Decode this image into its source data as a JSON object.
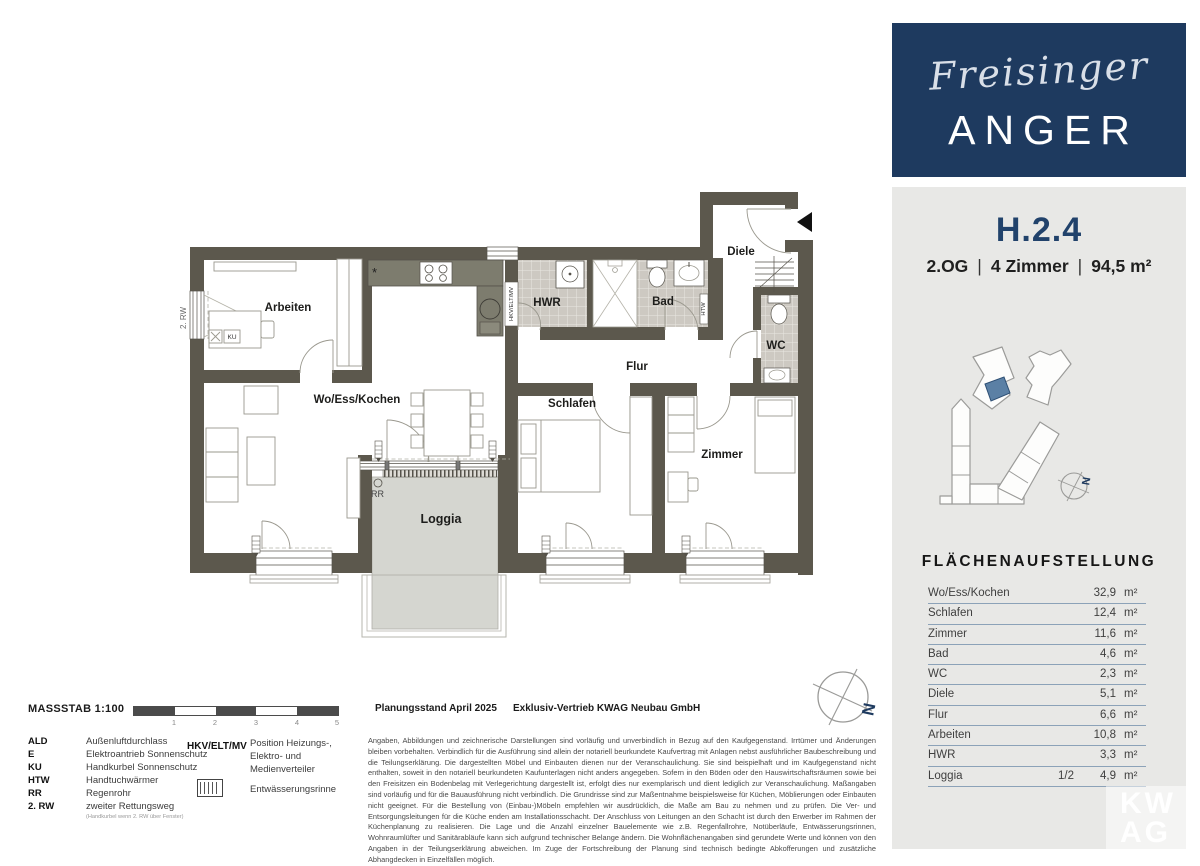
{
  "branding": {
    "script": "Freisinger",
    "name": "ANGER"
  },
  "unit": {
    "id": "H.2.4",
    "floor": "2.OG",
    "rooms": "4 Zimmer",
    "area": "94,5 m²",
    "separator": "|"
  },
  "area_table": {
    "title": "FLÄCHENAUFSTELLUNG",
    "rows": [
      {
        "label": "Wo/Ess/Kochen",
        "fraction": "",
        "value": "32,9",
        "unit": "m²"
      },
      {
        "label": "Schlafen",
        "fraction": "",
        "value": "12,4",
        "unit": "m²"
      },
      {
        "label": "Zimmer",
        "fraction": "",
        "value": "11,6",
        "unit": "m²"
      },
      {
        "label": "Bad",
        "fraction": "",
        "value": "4,6",
        "unit": "m²"
      },
      {
        "label": "WC",
        "fraction": "",
        "value": "2,3",
        "unit": "m²"
      },
      {
        "label": "Diele",
        "fraction": "",
        "value": "5,1",
        "unit": "m²"
      },
      {
        "label": "Flur",
        "fraction": "",
        "value": "6,6",
        "unit": "m²"
      },
      {
        "label": "Arbeiten",
        "fraction": "",
        "value": "10,8",
        "unit": "m²"
      },
      {
        "label": "HWR",
        "fraction": "",
        "value": "3,3",
        "unit": "m²"
      },
      {
        "label": "Loggia",
        "fraction": "1/2",
        "value": "4,9",
        "unit": "m²"
      }
    ]
  },
  "plan": {
    "rooms": {
      "arbeiten": "Arbeiten",
      "wohnen": "Wo/Ess/Kochen",
      "hwr": "HWR",
      "bad": "Bad",
      "diele": "Diele",
      "wc": "WC",
      "flur": "Flur",
      "schlafen": "Schlafen",
      "zimmer": "Zimmer",
      "loggia": "Loggia"
    },
    "markers": {
      "rw2": "2. RW",
      "rr": "RR",
      "htw": "HTW",
      "hkv": "HKV/ELT/MV",
      "ku": "KU",
      "north": "N"
    }
  },
  "legend": {
    "massstab": "MASSSTAB 1:100",
    "scale_ticks": [
      "1",
      "2",
      "3",
      "4",
      "5"
    ],
    "items": [
      {
        "abbr": "ALD",
        "desc": "Außenluftdurchlass"
      },
      {
        "abbr": "E",
        "desc": "Elektroantrieb Sonnenschutz"
      },
      {
        "abbr": "KU",
        "desc": "Handkurbel Sonnenschutz"
      },
      {
        "abbr": "HTW",
        "desc": "Handtuchwärmer"
      },
      {
        "abbr": "RR",
        "desc": "Regenrohr"
      },
      {
        "abbr": "2. RW",
        "desc": "zweiter Rettungsweg",
        "note": "(Handkurbel wenn 2. RW über Fenster)"
      }
    ],
    "hkv": {
      "abbr": "HKV/ELT/MV",
      "desc_lines": [
        "Position Heizungs-,",
        "Elektro- und",
        "Medienverteiler"
      ]
    },
    "drainage": "Entwässerungsrinne"
  },
  "footer": {
    "planungsstand": "Planungsstand April 2025",
    "vertrieb": "Exklusiv-Vertrieb  KWAG Neubau GmbH",
    "disclaimer": "Angaben, Abbildungen und zeichnerische Darstellungen sind vorläufig und unverbindlich in Bezug auf den Kaufgegenstand. Irrtümer und Änderungen bleiben vorbehalten. Verbindlich für die Ausführung sind allein der notariell beurkundete Kaufvertrag mit Anlagen nebst ausführlicher Baubeschreibung und die Teilungserklärung. Die dargestellten Möbel und Einbauten dienen nur der Veranschaulichung. Sie sind beispielhaft und im Kaufgegenstand nicht enthalten, soweit in den notariell beurkundeten Kaufunterlagen nicht anders angegeben. Sofern in den Böden oder den Hauswirtschaftsräumen sowie bei den Freisitzen ein Bodenbelag mit Verlegerichtung dargestellt ist, erfolgt dies nur exemplarisch und dient lediglich zur Veranschaulichung. Maßangaben sind vorläufig und für die Bauausführung nicht verbindlich. Die Grundrisse sind zur Maßentnahme beispielsweise für Küchen, Möblierungen oder Einbauten nicht geeignet. Für die Bestellung von (Einbau-)Möbeln empfehlen wir ausdrücklich, die Maße am Bau zu nehmen und zu prüfen. Die Ver- und Entsorgungsleitungen für die Küche enden am Installationsschacht. Der Anschluss von Leitungen an den Schacht ist durch den Erwerber im Rahmen der Küchenplanung zu realisieren. Die Lage und die Anzahl einzelner Bauelemente wie z.B. Regenfallrohre, Notüberläufe, Entwässerungsrinnen, Wohnraumlüfter und Sanitärabläufe kann sich aufgrund technischer Belange ändern. Die Wohnflächenangaben sind gerundete Werte und können von den Angaben in der Teilungserklärung abweichen. Im Zuge der Fortschreibung der Planung sind technisch bedingte Abkofferungen und zusätzliche Abhangdecken in Einzelfällen möglich."
  },
  "watermark": {
    "line1": "KW",
    "line2": "AG"
  },
  "colors": {
    "navy": "#1e3a5f",
    "panel": "#e8e8e6",
    "wall": "#5c584d",
    "counter": "#7d7c6e",
    "tile": "#cdc9c2",
    "loggia_floor": "#d5d6d0",
    "unit_highlight": "#5b80a5",
    "table_line": "#8ca2b8"
  }
}
